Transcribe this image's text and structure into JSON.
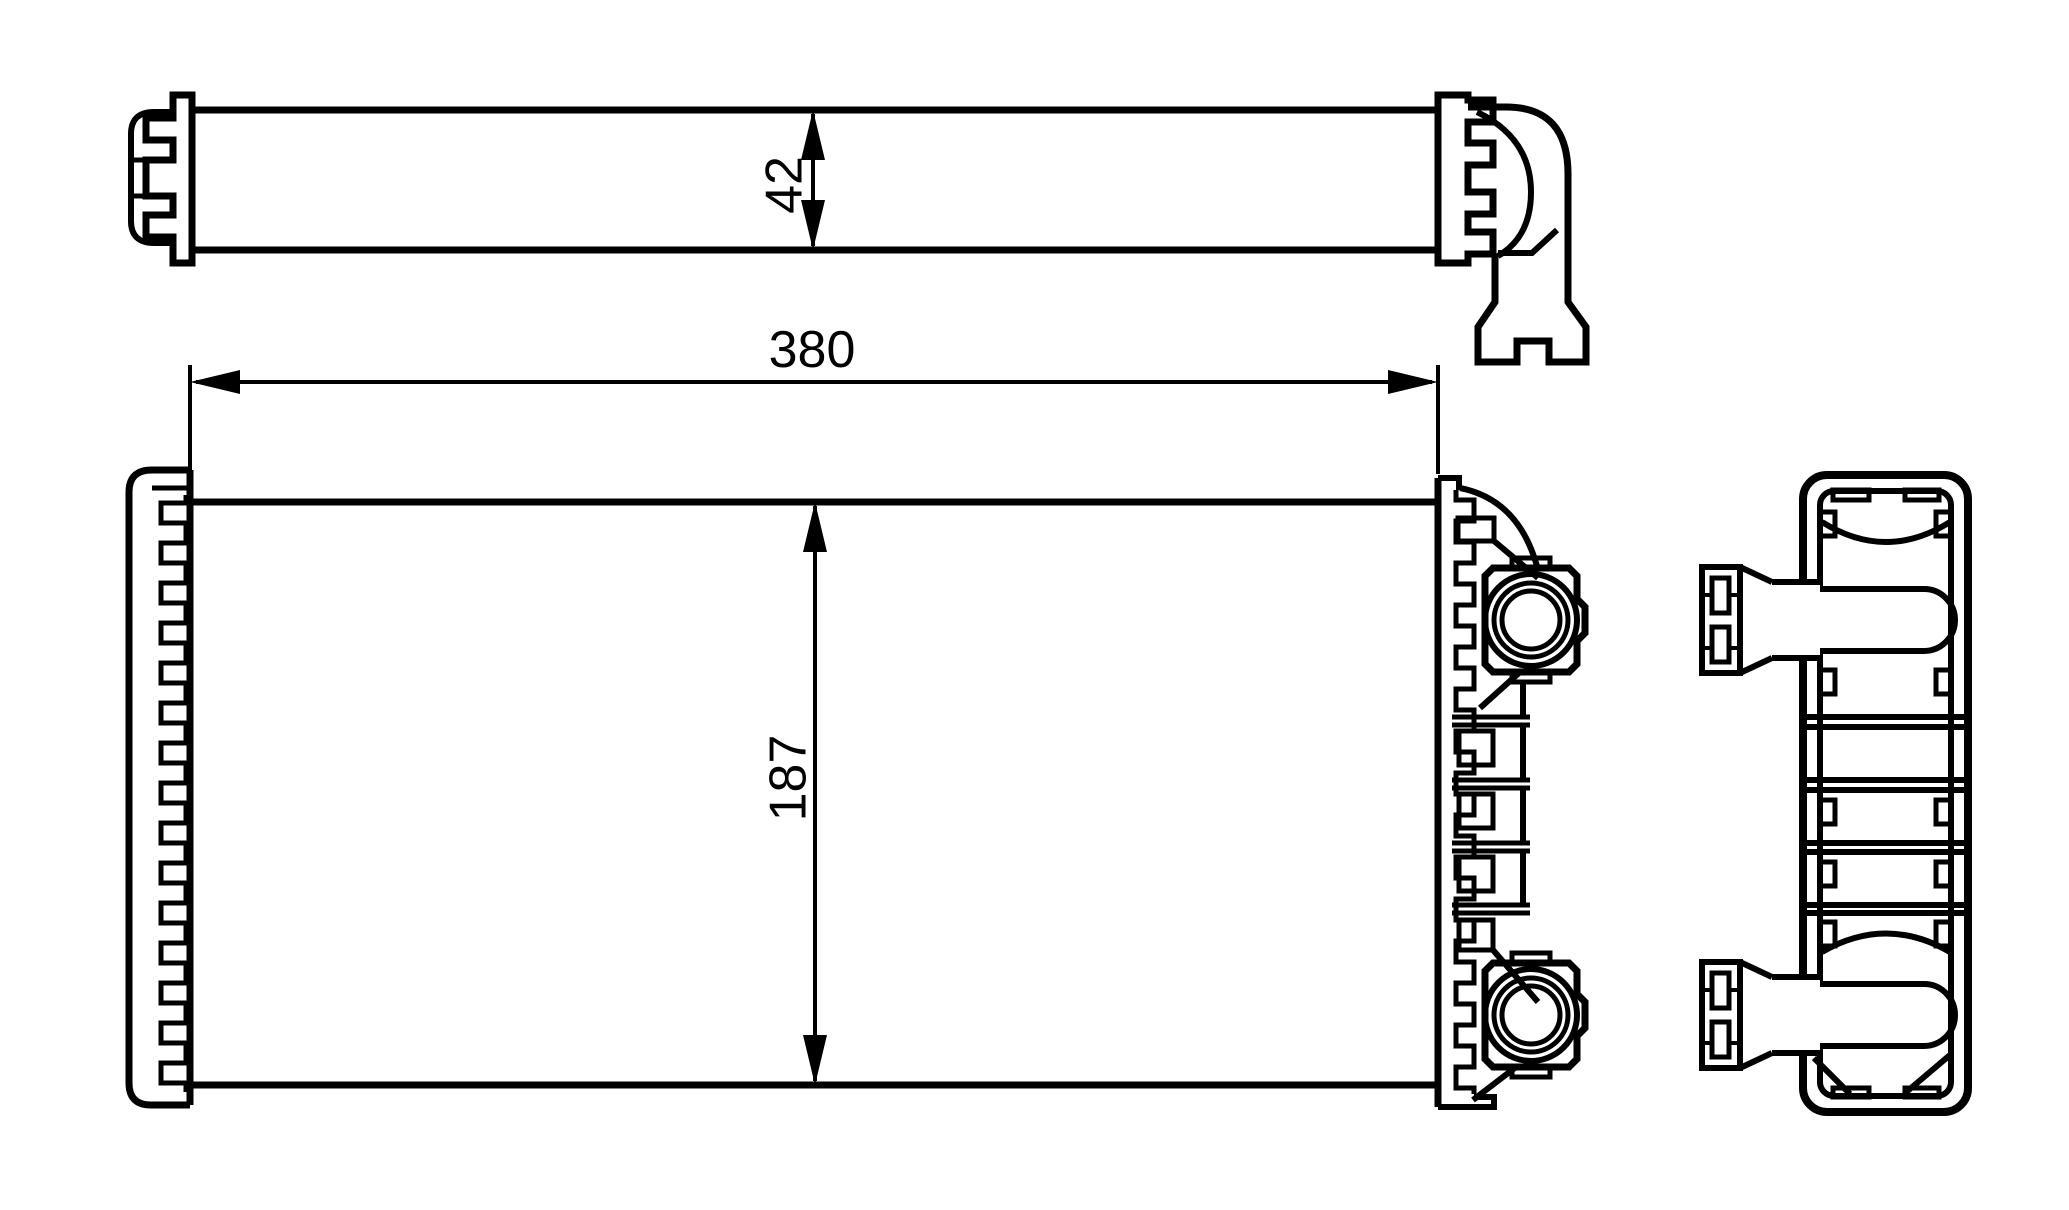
{
  "drawing": {
    "background_color": "#ffffff",
    "line_color": "#000000",
    "dimensions": {
      "width": {
        "label": "380"
      },
      "height": {
        "label": "187"
      },
      "depth": {
        "label": "42"
      }
    }
  }
}
